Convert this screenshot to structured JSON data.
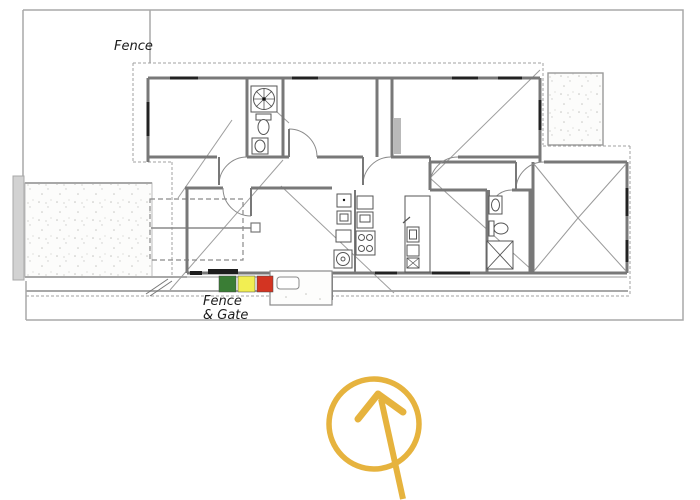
{
  "labels": {
    "fence_boundary": "Fence",
    "gate_line1": "Fence",
    "gate_line2": "& Gate"
  },
  "markers": {
    "green": "#3a7d35",
    "yellow": "#f2ee52",
    "red": "#d33422"
  },
  "annotation": {
    "shape": "circled-up-arrow",
    "color": "#e6b33e"
  },
  "plan_colors": {
    "wall": "#787878",
    "boundary": "#a8a8a8",
    "window": "#222222",
    "fence_bar_fill": "#d2d2d2"
  }
}
